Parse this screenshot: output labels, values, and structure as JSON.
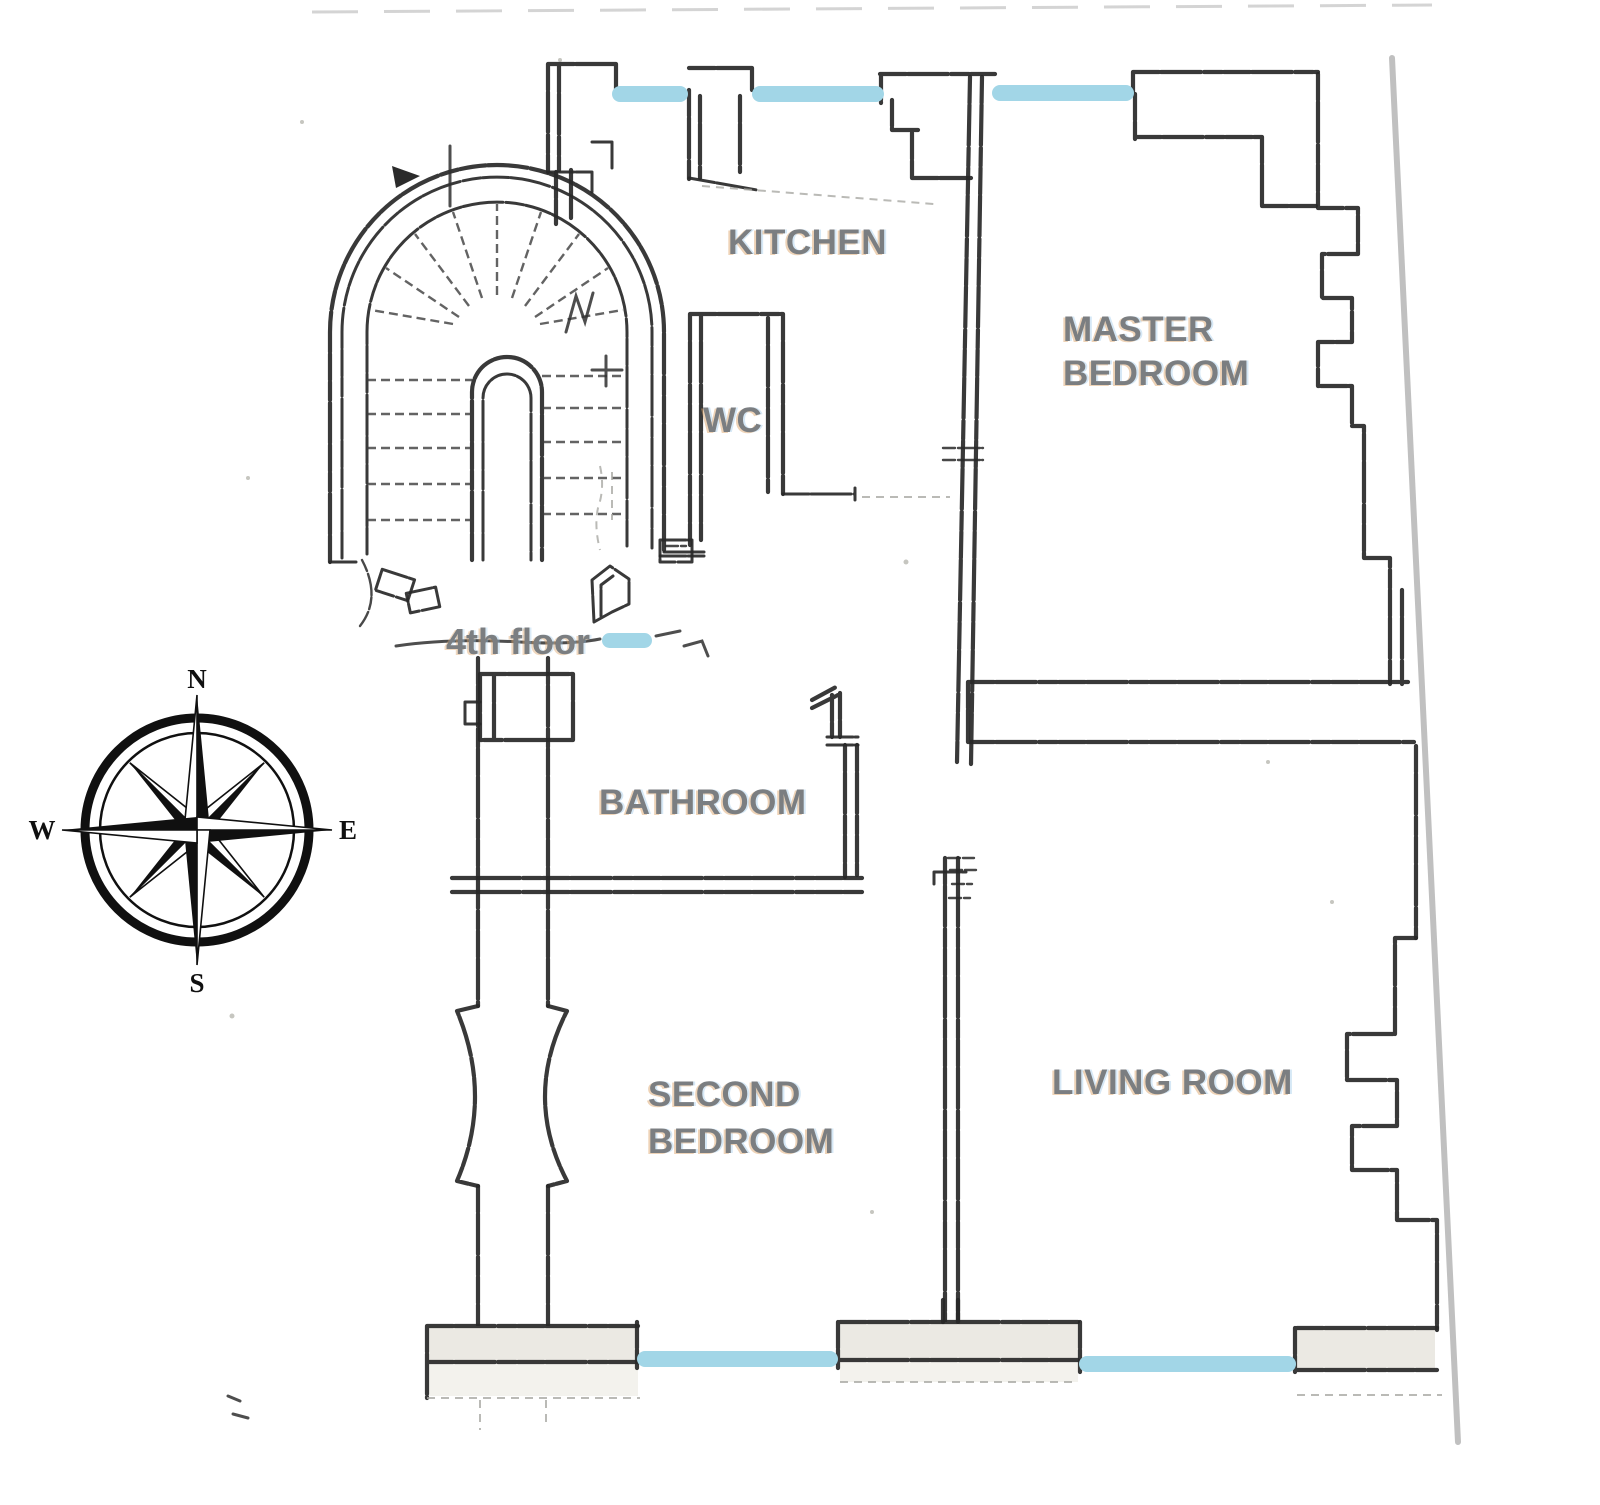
{
  "floor_plan": {
    "floor_label": "4th floor",
    "rooms": [
      {
        "name": "kitchen",
        "lines": [
          "KITCHEN"
        ]
      },
      {
        "name": "master-bedroom",
        "lines": [
          "MASTER",
          "BEDROOM"
        ]
      },
      {
        "name": "wc",
        "lines": [
          "WC"
        ]
      },
      {
        "name": "bathroom",
        "lines": [
          "BATHROOM"
        ]
      },
      {
        "name": "second-bedroom",
        "lines": [
          "SECOND",
          "BEDROOM"
        ]
      },
      {
        "name": "living-room",
        "lines": [
          "LIVING ROOM"
        ]
      }
    ],
    "window_highlights": [
      {
        "name": "north-window-kitchen-left",
        "x": 612,
        "y": 86,
        "w": 76,
        "h": 16
      },
      {
        "name": "north-window-kitchen-right",
        "x": 752,
        "y": 86,
        "w": 132,
        "h": 16
      },
      {
        "name": "north-window-master-bedroom",
        "x": 992,
        "y": 85,
        "w": 142,
        "h": 16
      },
      {
        "name": "stair-landing-highlight",
        "x": 602,
        "y": 633,
        "w": 50,
        "h": 15
      },
      {
        "name": "south-window-second-bedroom",
        "x": 637,
        "y": 1351,
        "w": 201,
        "h": 16
      },
      {
        "name": "south-window-living-room",
        "x": 1079,
        "y": 1356,
        "w": 217,
        "h": 16
      }
    ],
    "colors": {
      "window_highlight": "#a2d6e7",
      "room_label": "#7b7e81",
      "wall_ink": "#282828",
      "page_edge": "#b5b5b5"
    }
  },
  "compass": {
    "directions": {
      "north": "N",
      "east": "E",
      "south": "S",
      "west": "W"
    }
  }
}
